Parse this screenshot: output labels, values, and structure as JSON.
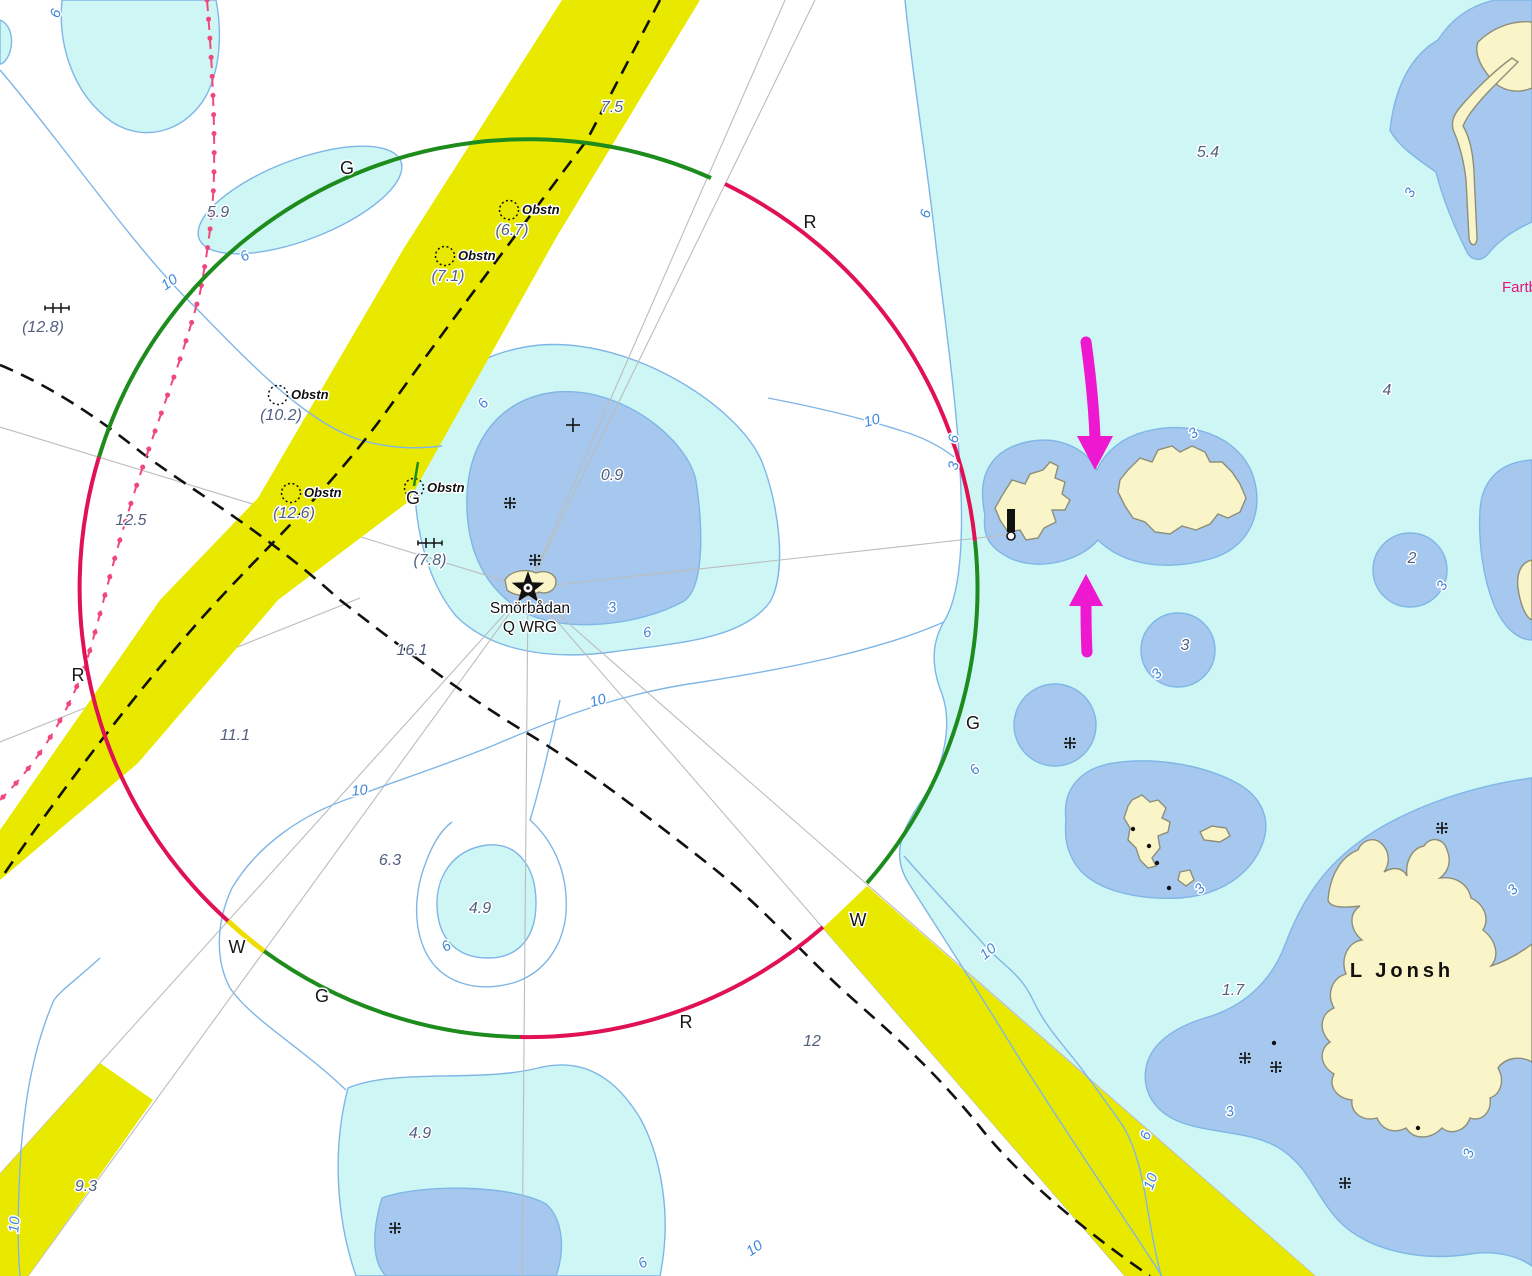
{
  "chart": {
    "colors": {
      "fairway_yellow": "#e9e900",
      "shallow_cyan": "#cdf6f5",
      "shoal_blue": "#a6c8ee",
      "land_cream": "#faf4c9",
      "contour_blue": "#7fb6e6",
      "sector_green": "#1d8c1d",
      "sector_red": "#e01253",
      "cable_pink": "#f0487c",
      "arrow_magenta": "#ee18d0"
    },
    "light": {
      "name": "Smörbådan",
      "characteristic": "Q WRG"
    },
    "island_name": "L Jonsh",
    "speed_note": "Fartb",
    "sector_labels": [
      {
        "t": "G",
        "x": 347,
        "y": 174
      },
      {
        "t": "R",
        "x": 810,
        "y": 228
      },
      {
        "t": "R",
        "x": 78,
        "y": 681
      },
      {
        "t": "G",
        "x": 973,
        "y": 729
      },
      {
        "t": "W",
        "x": 237,
        "y": 953
      },
      {
        "t": "G",
        "x": 322,
        "y": 1002
      },
      {
        "t": "R",
        "x": 686,
        "y": 1028
      },
      {
        "t": "W",
        "x": 858,
        "y": 926
      }
    ],
    "depths": [
      {
        "t": "5.9",
        "x": 218,
        "y": 217
      },
      {
        "t": "7.5",
        "x": 612,
        "y": 112
      },
      {
        "t": "12.5",
        "x": 131,
        "y": 525
      },
      {
        "t": "0.9",
        "x": 612,
        "y": 480
      },
      {
        "t": "16.1",
        "x": 412,
        "y": 655
      },
      {
        "t": "11.1",
        "x": 235,
        "y": 740
      },
      {
        "t": "6.3",
        "x": 390,
        "y": 865
      },
      {
        "t": "4.9",
        "x": 480,
        "y": 913
      },
      {
        "t": "4.9",
        "x": 420,
        "y": 1138
      },
      {
        "t": "9.3",
        "x": 86,
        "y": 1191
      },
      {
        "t": "12",
        "x": 812,
        "y": 1046
      },
      {
        "t": "5.4",
        "x": 1208,
        "y": 157
      },
      {
        "t": "4",
        "x": 1387,
        "y": 395
      },
      {
        "t": "2",
        "x": 1412,
        "y": 563
      },
      {
        "t": "3",
        "x": 1185,
        "y": 650
      },
      {
        "t": "1.7",
        "x": 1233,
        "y": 995
      }
    ],
    "obstructions": [
      {
        "label": "Obstn",
        "depth": "(6.7)",
        "cx": 509,
        "cy": 210
      },
      {
        "label": "Obstn",
        "depth": "(7.1)",
        "cx": 445,
        "cy": 256
      },
      {
        "label": "Obstn",
        "depth": "(10.2)",
        "cx": 278,
        "cy": 395
      },
      {
        "label": "Obstn",
        "depth": "(12.6)",
        "cx": 291,
        "cy": 493
      },
      {
        "label": "Obstn",
        "depth": "",
        "cx": 414,
        "cy": 488,
        "buoy": "G"
      }
    ],
    "swept_soundings": [
      {
        "depth": "(12.8)",
        "sx": 57,
        "sy": 308,
        "x": 43,
        "y": 332
      },
      {
        "depth": "(7.8)",
        "sx": 430,
        "sy": 543,
        "x": 430,
        "y": 565
      }
    ],
    "contour_labels": [
      {
        "t": "6",
        "x": 60,
        "y": 15,
        "r": -70
      },
      {
        "t": "10",
        "x": 172,
        "y": 286,
        "r": -35
      },
      {
        "t": "6",
        "x": 247,
        "y": 260,
        "r": -30
      },
      {
        "t": "6",
        "x": 487,
        "y": 406,
        "r": -55
      },
      {
        "t": "10",
        "x": 873,
        "y": 425,
        "r": -15
      },
      {
        "t": "3",
        "x": 613,
        "y": 612,
        "r": -10
      },
      {
        "t": "6",
        "x": 648,
        "y": 637,
        "r": -10
      },
      {
        "t": "10",
        "x": 599,
        "y": 705,
        "r": -15
      },
      {
        "t": "10",
        "x": 360,
        "y": 795,
        "r": -5
      },
      {
        "t": "6",
        "x": 449,
        "y": 950,
        "r": -35
      },
      {
        "t": "6",
        "x": 930,
        "y": 215,
        "r": -75
      },
      {
        "t": "6",
        "x": 958,
        "y": 440,
        "r": -75
      },
      {
        "t": "3",
        "x": 958,
        "y": 467,
        "r": -75
      },
      {
        "t": "6",
        "x": 978,
        "y": 773,
        "r": -45
      },
      {
        "t": "3",
        "x": 1196,
        "y": 437,
        "r": -35
      },
      {
        "t": "3",
        "x": 1446,
        "y": 588,
        "r": -60
      },
      {
        "t": "3",
        "x": 1160,
        "y": 677,
        "r": -45
      },
      {
        "t": "3",
        "x": 1203,
        "y": 892,
        "r": -45
      },
      {
        "t": "3",
        "x": 1414,
        "y": 195,
        "r": -60
      },
      {
        "t": "10",
        "x": 991,
        "y": 955,
        "r": -40
      },
      {
        "t": "6",
        "x": 1150,
        "y": 1137,
        "r": -70
      },
      {
        "t": "10",
        "x": 1155,
        "y": 1183,
        "r": -70
      },
      {
        "t": "3",
        "x": 1231,
        "y": 1116,
        "r": -15
      },
      {
        "t": "3",
        "x": 1473,
        "y": 1155,
        "r": -70
      },
      {
        "t": "3",
        "x": 1516,
        "y": 893,
        "r": -45
      },
      {
        "t": "10",
        "x": 19,
        "y": 1225,
        "r": -85
      },
      {
        "t": "6",
        "x": 645,
        "y": 1267,
        "r": -30
      },
      {
        "t": "10",
        "x": 757,
        "y": 1252,
        "r": -35
      }
    ],
    "symbols": {
      "rocks_awash": [
        [
          510,
          503
        ],
        [
          535,
          560
        ],
        [
          1070,
          743
        ],
        [
          1442,
          828
        ],
        [
          1245,
          1058
        ],
        [
          1276,
          1067
        ],
        [
          1345,
          1183
        ],
        [
          395,
          1228
        ]
      ],
      "rocks_submerged": [
        [
          573,
          425
        ]
      ],
      "islet_dots": [
        [
          1133,
          829
        ],
        [
          1149,
          846
        ],
        [
          1157,
          863
        ],
        [
          1169,
          888
        ],
        [
          1274,
          1043
        ],
        [
          1418,
          1128
        ]
      ]
    }
  }
}
